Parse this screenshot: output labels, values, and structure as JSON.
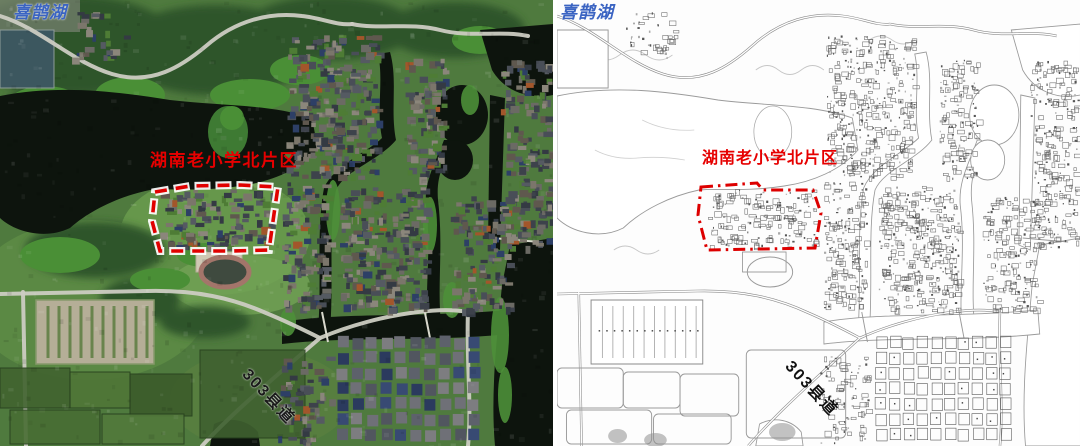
{
  "map": {
    "lake_label": "喜鹊湖",
    "area_label": "湖南老小学北片区",
    "road_label": "303县道"
  },
  "colors": {
    "lake_label_blue": "#3b64c2",
    "area_label_red": "#e60000",
    "boundary_red": "#dd0000",
    "road_label_dark": "#1a1a1a"
  }
}
